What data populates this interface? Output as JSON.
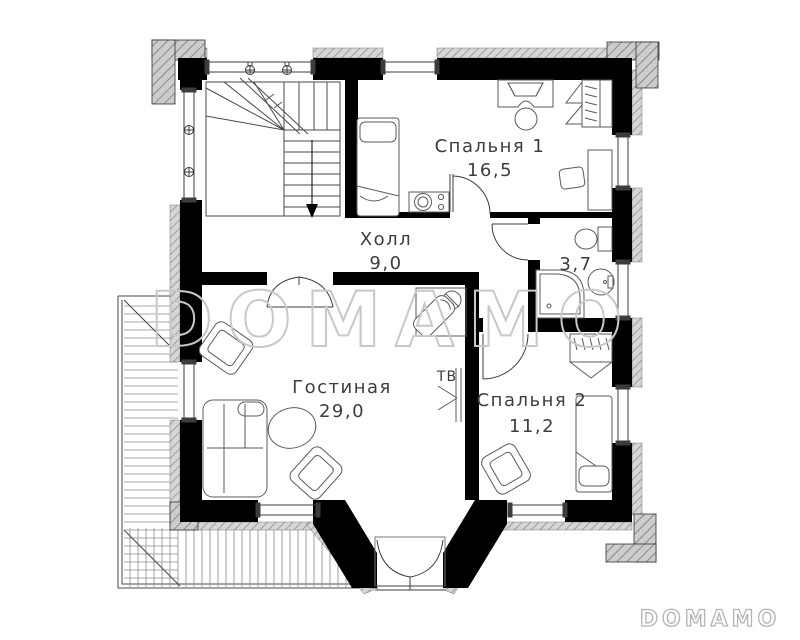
{
  "plan_title": "Floor plan, second floor",
  "rooms": [
    {
      "id": "bedroom1",
      "name": "Спальня 1",
      "area": "16,5"
    },
    {
      "id": "hall",
      "name": "Холл",
      "area": "9,0"
    },
    {
      "id": "bathroom",
      "name": "",
      "area": "3,7"
    },
    {
      "id": "living",
      "name": "Гостиная",
      "area": "29,0"
    },
    {
      "id": "bedroom2",
      "name": "Спальня 2",
      "area": "11,2"
    }
  ],
  "labels": {
    "tv": "ТВ"
  },
  "watermark": {
    "center": "DOMAMO",
    "corner": "DOMAMO"
  },
  "colors": {
    "wall": "#000000",
    "line": "#4a4a4a",
    "furniture_line": "#5a5a5a",
    "exterior_hatch": "#cfcfcf",
    "pillar_hatch": "#c4c4c4",
    "watermark": "#c8c8c8",
    "label_text": "#3d3d3d",
    "background": "#ffffff"
  }
}
